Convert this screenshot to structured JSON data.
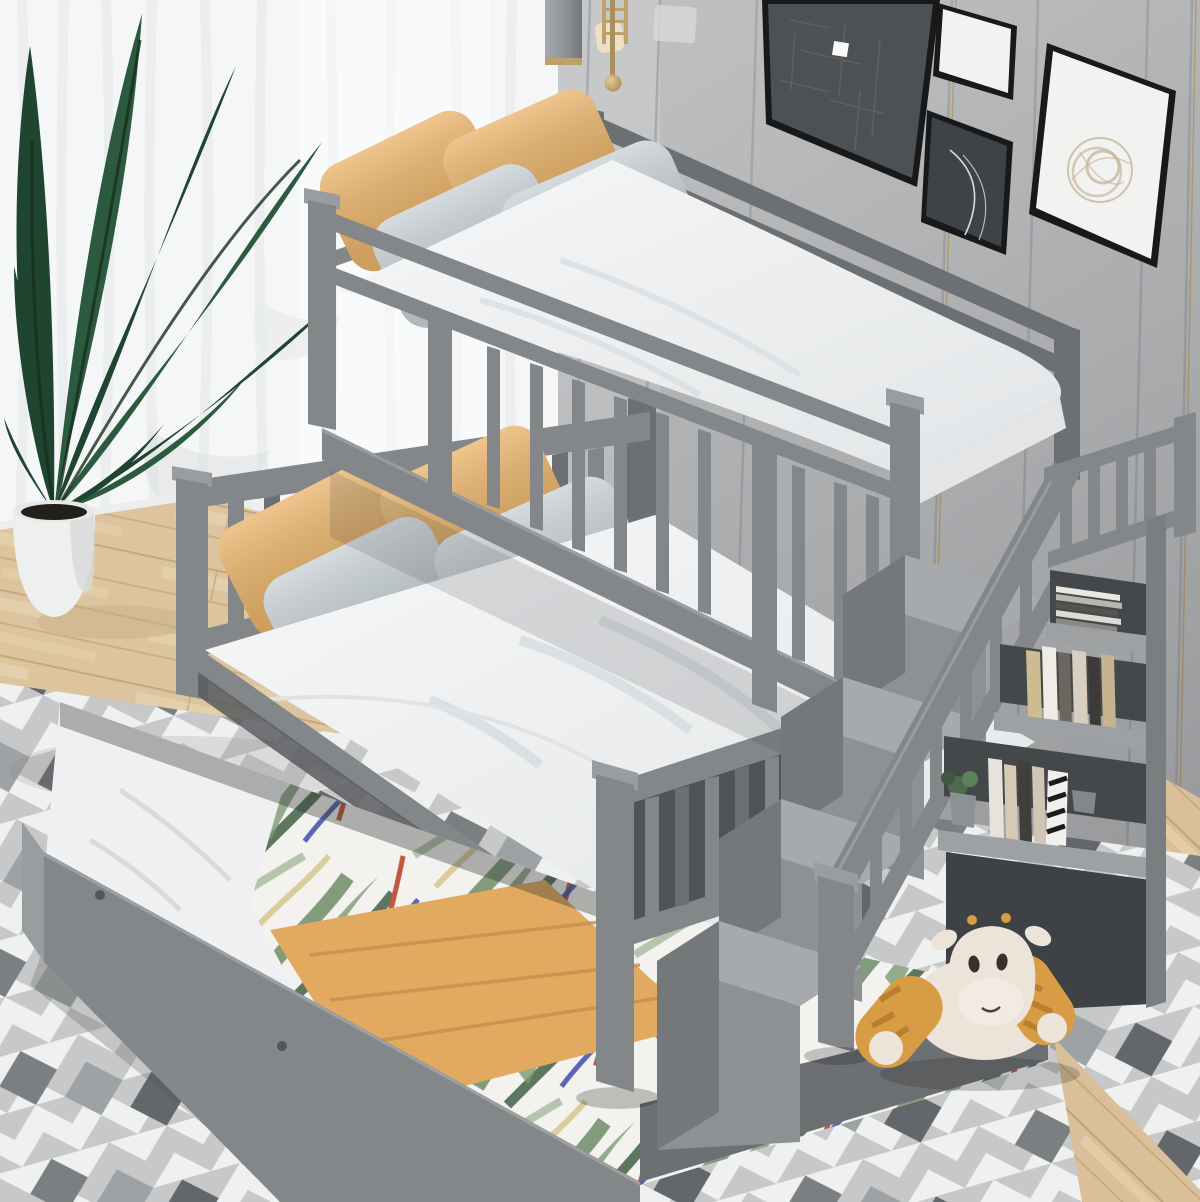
{
  "image": {
    "kind": "product-room-photograph",
    "subject": "gray twin-over-full bunk bed with storage staircase, bookshelf cubbies and pulled-out trundle bed",
    "setting": "bedroom with sheer white curtains, gray paneled wall, gallery frames, potted plant, chevron rug on light wood floor"
  },
  "palette": {
    "curtain": "#f5f6f7",
    "curtain_fold": "#e4e7e9",
    "wall": "#bcbec0",
    "wall_light": "#c9cbcd",
    "wall_seam": "#a3a5a8",
    "baseboard": "#eceeee",
    "wood": "#dcc49e",
    "wood_dark": "#c3a87c",
    "rug_white": "#eff0f0",
    "rug_gray": "#c6c8ca",
    "rug_dark": "#63666a",
    "bed": "#84878a",
    "bed_light": "#9a9da0",
    "bed_dark": "#6d7073",
    "bed_darker": "#565a5d",
    "mattress": "#f1f2f3",
    "pillow_orange": "#e9b267",
    "pillow_gray": "#c7d0d5",
    "blanket": "#e2a960",
    "floral_base": "#f3f2ee",
    "leaf_green": "#6e8c68",
    "leaf_green_dark": "#4d6850",
    "accent_red": "#c25840",
    "accent_blue": "#4a57ad",
    "accent_yellow": "#d4c387",
    "plant": "#1f4430",
    "plant_light": "#2c5a3e",
    "pot": "#eef0f0",
    "frame": "#17191a",
    "art_dark": "#4e5154",
    "art_white": "#f2f2f1",
    "brass": "#bfa06a",
    "lamp": "#8e9398",
    "step_top": "#a7aaac",
    "step_front": "#8e9194",
    "step_side": "#75787b",
    "shelf": "#9ea1a4",
    "cubby": "#45484b",
    "book_white": "#e9e7e3",
    "book_tan": "#cdbb92",
    "book_dark": "#443f3a",
    "giraffe": "#ece4d8",
    "giraffe_orange": "#d89d44"
  },
  "scene": {
    "objects": [
      {
        "name": "sheer-curtain-window",
        "color": "curtain"
      },
      {
        "name": "paneled-accent-wall",
        "color": "wall"
      },
      {
        "name": "gallery-wall-frames",
        "count": 4,
        "color": "frame"
      },
      {
        "name": "pendant-lamp",
        "color": "lamp"
      },
      {
        "name": "brass-wall-sconce",
        "color": "brass"
      },
      {
        "name": "potted-banana-plant",
        "color": "plant"
      },
      {
        "name": "twin-top-bunk-with-guardrails",
        "color": "bed"
      },
      {
        "name": "full-bottom-bed-with-slatted-headboard",
        "color": "bed"
      },
      {
        "name": "storage-staircase-with-railing",
        "color": "bed"
      },
      {
        "name": "bookshelf-cubbies-with-books-and-plant",
        "color": "shelf"
      },
      {
        "name": "pulled-out-trundle-with-tropical-comforter",
        "color": "floral_base"
      },
      {
        "name": "folded-orange-blanket",
        "color": "blanket"
      },
      {
        "name": "plush-giraffe-toy",
        "color": "giraffe"
      },
      {
        "name": "chevron-area-rug",
        "color": "rug_gray"
      },
      {
        "name": "light-oak-floor",
        "color": "wood"
      }
    ],
    "pillows": {
      "orange_count": 4,
      "gray_count": 4
    }
  }
}
